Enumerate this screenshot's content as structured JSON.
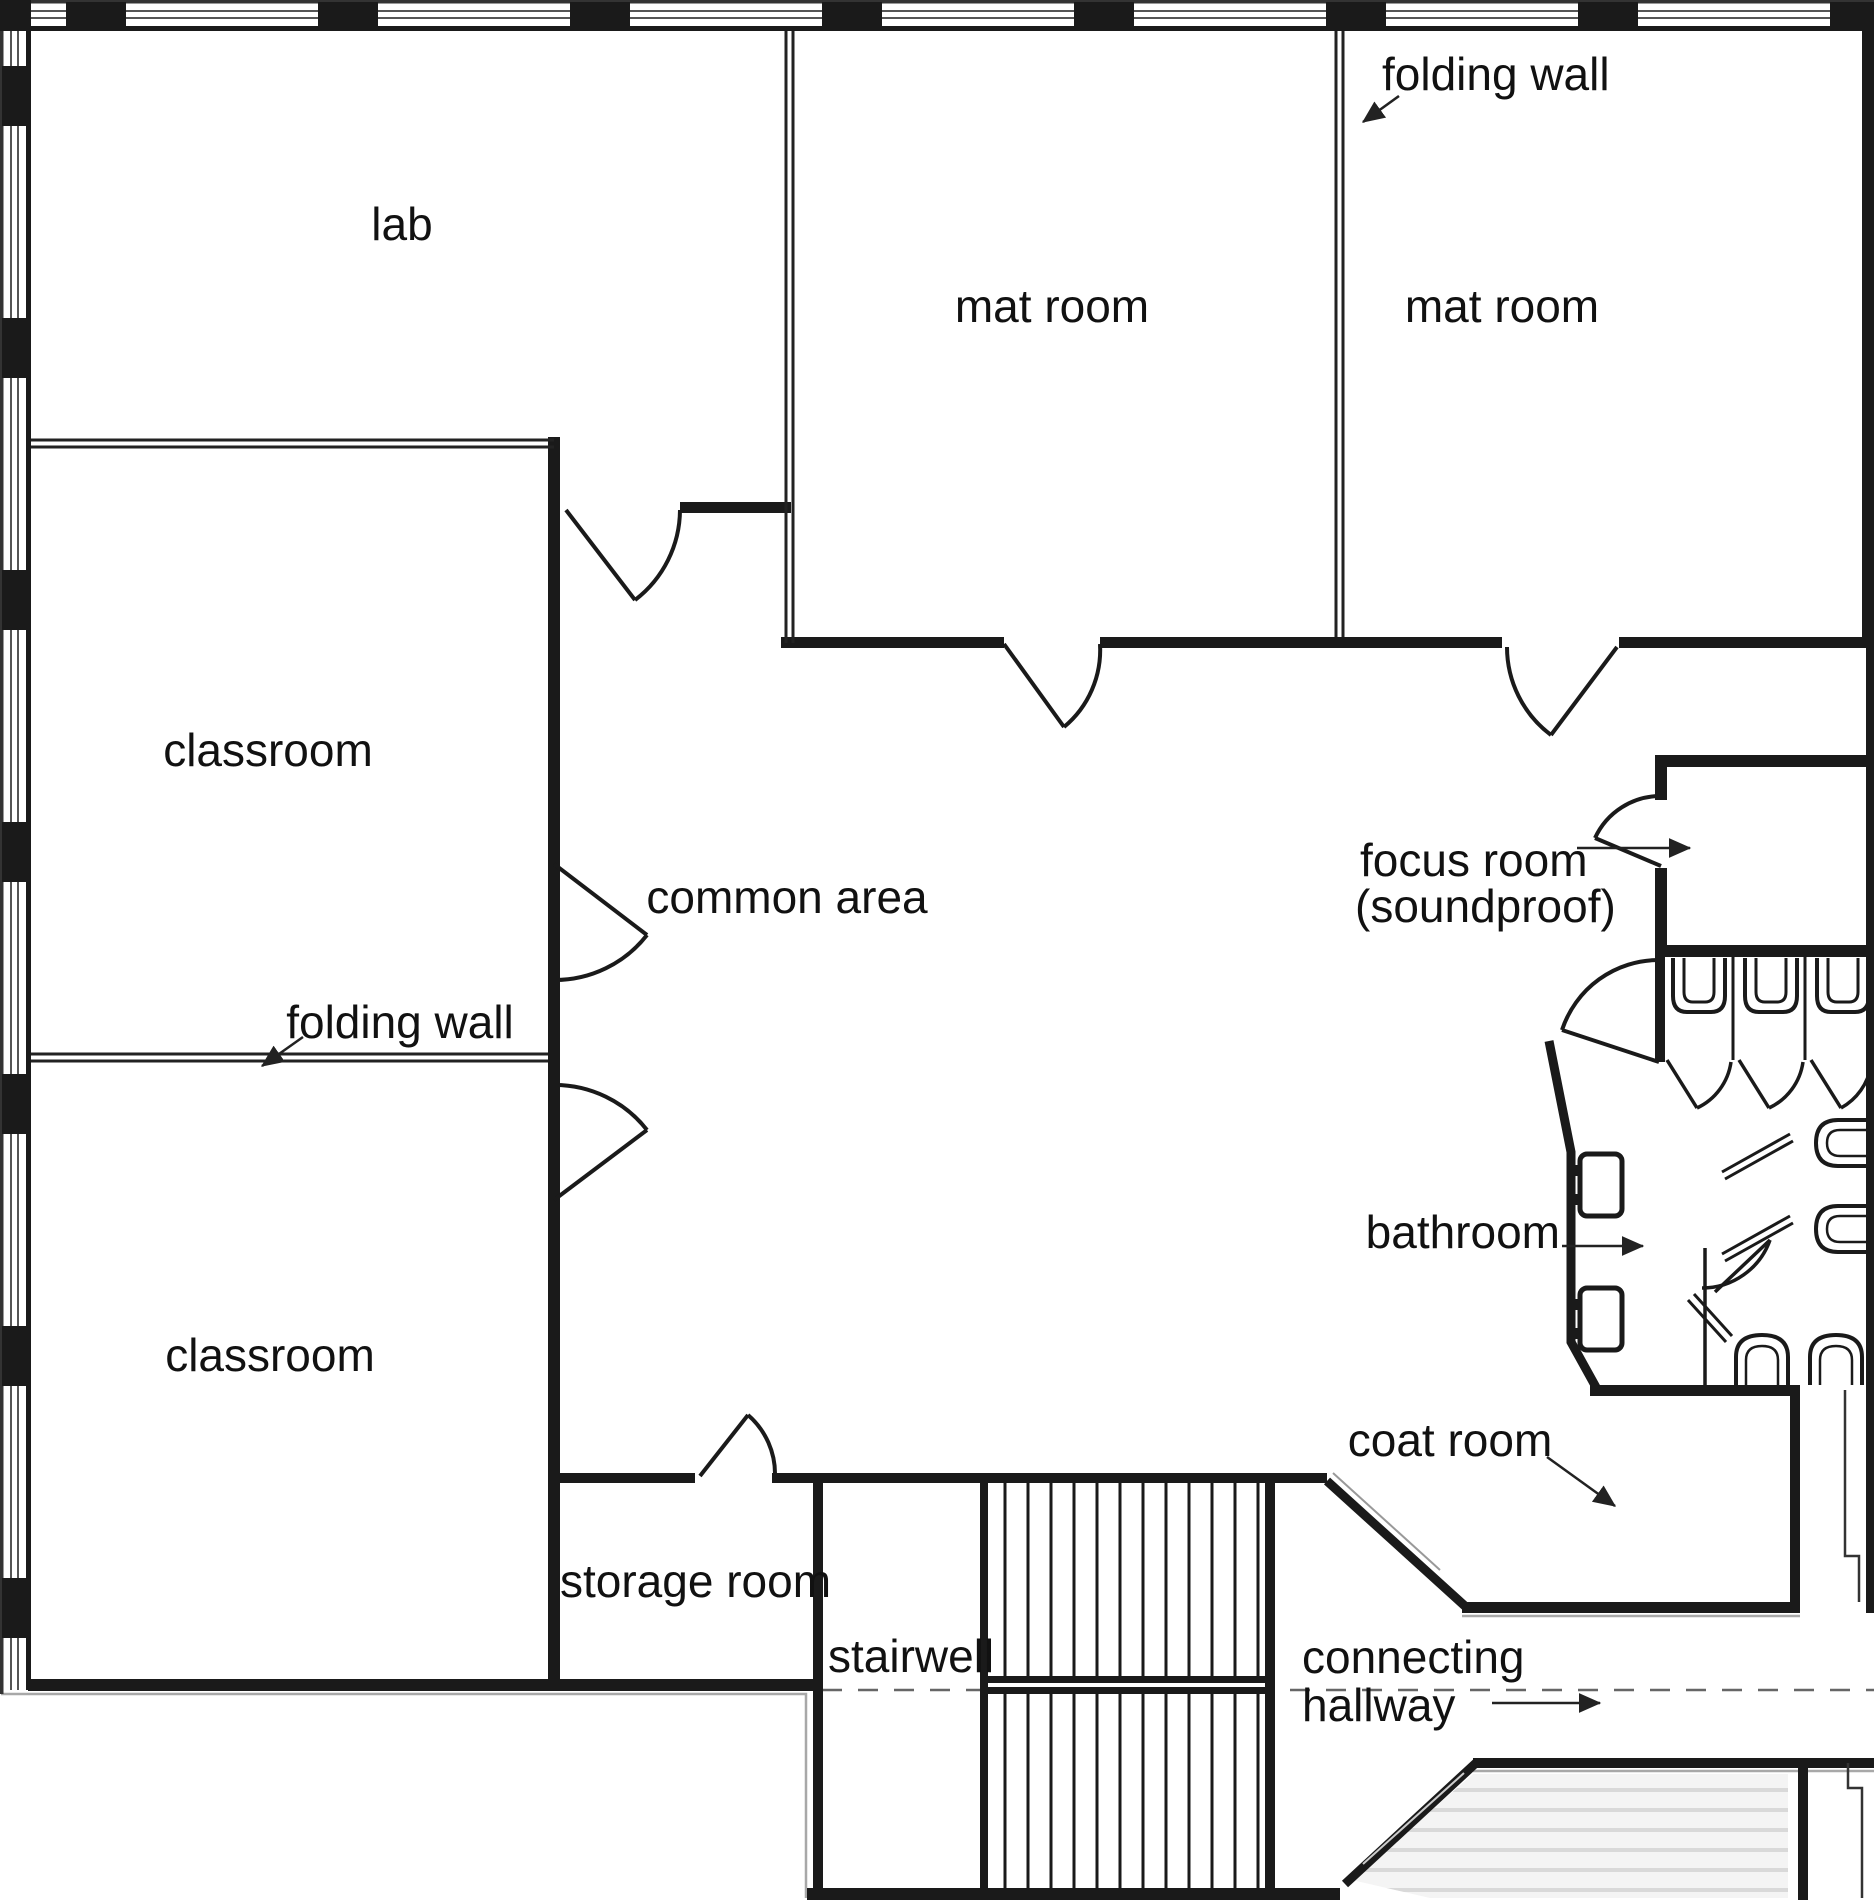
{
  "diagram": {
    "type": "architectural-floor-plan",
    "background_color": "#ffffff",
    "wall_color": "#1a1a1a",
    "outline_gray": "#a8a8a8",
    "dash_color": "#666666",
    "text_color": "#111111",
    "lower_level_fill": "#f4f4f4"
  },
  "labels": {
    "lab": "lab",
    "classroom_upper": "classroom",
    "classroom_lower": "classroom",
    "mat_room_left": "mat room",
    "mat_room_right": "mat room",
    "common_area": "common area",
    "storage_room": "storage room",
    "stairwell": "stairwell",
    "focus_room_line1": "focus room",
    "focus_room_line2": "(soundproof)",
    "bathroom": "bathroom",
    "coat_room": "coat room",
    "hallway_line1": "connecting",
    "hallway_line2": "hallway",
    "folding_wall_top": "folding wall",
    "folding_wall_left": "folding wall"
  }
}
